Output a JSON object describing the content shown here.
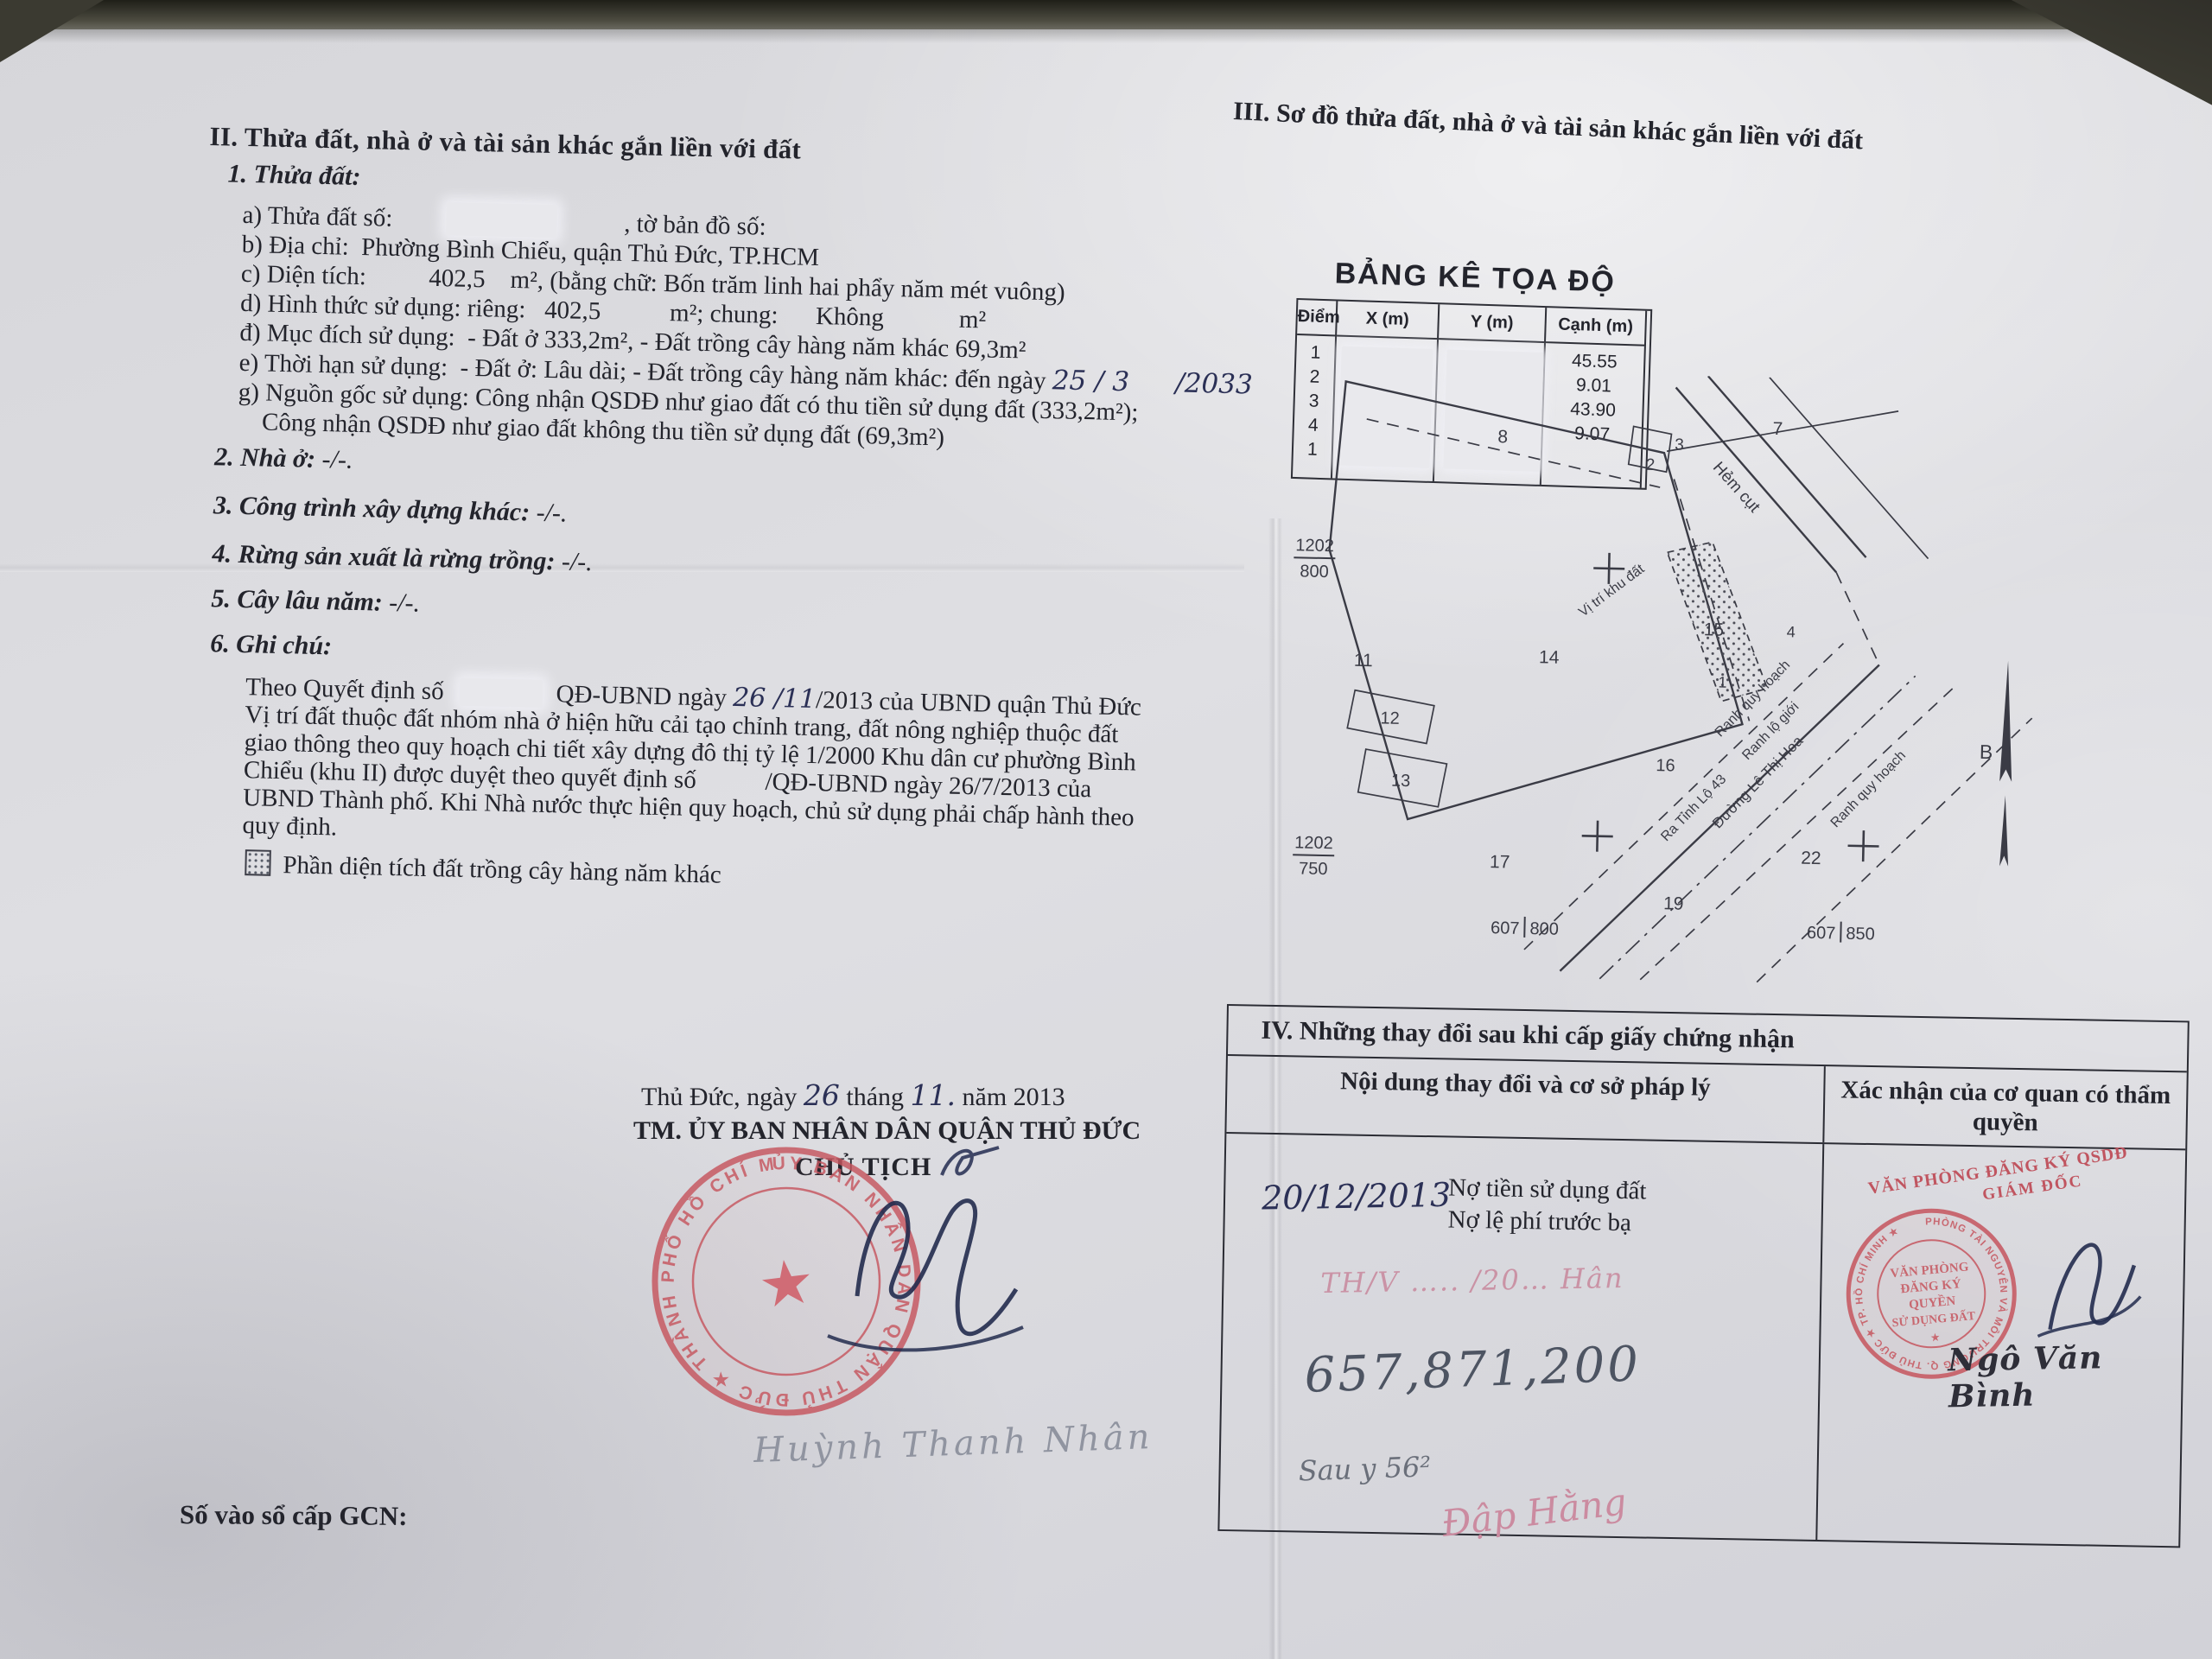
{
  "colors": {
    "paper": "#dcdce0",
    "ink": "#23242c",
    "stamp_red": "#c6555e",
    "handwriting_blue": "#2b3056",
    "handwriting_pink": "#c98ca0",
    "pencil_gray": "#4d5462"
  },
  "section2": {
    "title": "II. Thửa đất, nhà ở và tài sản khác gắn liền với đất",
    "sub_title": "1. Thửa đất:",
    "line_a_pre": "a) Thửa đất số:",
    "line_a_post": ", tờ bản đồ số:",
    "line_b": "b) Địa chỉ:  Phường Bình Chiểu, quận Thủ Đức, TP.HCM",
    "line_c": "c) Diện tích:          402,5    m², (bằng chữ: Bốn trăm linh hai phẩy năm mét vuông)",
    "line_d": "d) Hình thức sử dụng: riêng:   402,5           m²; chung:      Không            m²",
    "line_dd": "đ) Mục đích sử dụng:  - Đất ở 333,2m², - Đất trồng cây hàng năm khác 69,3m²",
    "line_e_pre": "e) Thời hạn sử dụng:  - Đất ở: Lâu dài; - Đất trồng cây hàng năm khác: đến ngày",
    "line_e_hw1": "25 / 3",
    "line_e_hw2": "/2033",
    "line_g1": "g) Nguồn gốc sử dụng: Công nhận QSDĐ như giao đất có thu tiền sử dụng đất (333,2m²);",
    "line_g2": "Công nhận QSDĐ như giao đất không thu tiền sử dụng đất (69,3m²)",
    "item2_label": "2. Nhà ở:",
    "item2_value": " -/-.",
    "item3_label": "3. Công trình xây dựng khác:",
    "item3_value": " -/-.",
    "item4_label": "4. Rừng sản xuất là rừng trồng:",
    "item4_value": " -/-.",
    "item5_label": "5. Cây lâu năm:",
    "item5_value": " -/-.",
    "item6_label": "6. Ghi chú:",
    "note1_pre": "Theo Quyết định số",
    "note1_mid": "QĐ-UBND ngày",
    "note1_hw": "26 /11",
    "note1_post": "/2013 của UBND quận Thủ Đức",
    "note2": "Vị trí đất thuộc đất nhóm nhà ở hiện hữu cải tạo chỉnh trang, đất nông nghiệp thuộc đất",
    "note3": "giao thông theo quy hoạch chi tiết xây dựng đô thị tỷ lệ 1/2000 Khu dân cư phường Bình",
    "note4": "Chiểu (khu II) được duyệt theo quyết định số           /QĐ-UBND ngày 26/7/2013 của",
    "note5": "UBND Thành phố. Khi Nhà nước thực hiện quy hoạch, chủ sử dụng phải chấp hành theo",
    "note6": "quy định.",
    "legend": "Phần diện tích đất trồng cây hàng năm khác"
  },
  "section3": {
    "title": "III. Sơ đồ thửa đất, nhà ở và tài sản khác gắn liền với đất",
    "table": {
      "title": "BẢNG KÊ TỌA ĐỘ",
      "headers": [
        "Điểm",
        "X (m)",
        "Y (m)",
        "Cạnh (m)"
      ],
      "points": [
        "1",
        "2",
        "3",
        "4",
        "1"
      ],
      "edges": [
        "",
        "45.55",
        "9.01",
        "43.90",
        "9.07"
      ]
    },
    "diagram": {
      "plots": {
        "p1": "1",
        "p2": "2",
        "p3": "3",
        "p4": "4",
        "p7": "7",
        "p8": "8",
        "p11": "11",
        "p12": "12",
        "p13": "13",
        "p14": "14",
        "p15": "15",
        "p16": "16",
        "p17": "17",
        "p19": "19",
        "p22": "22"
      },
      "labels": {
        "hem_cut": "Hẻm cụt",
        "vi_tri": "Vị trí khu đất",
        "ranh_qh1": "Ranh quy hoạch",
        "ranh_lg": "Ranh lộ giới",
        "ra_tl43": "Ra Tỉnh Lộ 43",
        "duong": "Đường Lê Thị Hoa",
        "ranh_qh2": "Ranh quy hoạch",
        "north": "B"
      },
      "coords": {
        "f1n": "1202",
        "f1d": "800",
        "f2n": "1202",
        "f2d": "750",
        "f3n": "607",
        "f3d": "800",
        "f4n": "607",
        "f4d": "850"
      }
    }
  },
  "section4": {
    "title": "IV. Những thay đổi sau khi cấp giấy chứng nhận",
    "col_content": "Nội dung thay đổi và cơ sở pháp lý",
    "col_confirm": "Xác nhận của cơ quan có thẩm quyền",
    "entry_date": "20/12/2013",
    "debt_line1": "Nợ tiền sử dụng đất",
    "debt_line2": "Nợ lệ phí trước bạ",
    "hw_ref": "TH/V ….. /20…   Hân",
    "hw_amount": "657,871,200",
    "hw_note": "Sau y 56²",
    "hw_sign": "Đập Hằng",
    "stamp_caption1": "VĂN PHÒNG ĐĂNG KÝ QSDĐ",
    "stamp_caption2": "GIÁM ĐỐC",
    "stamp_ring": "PHÒNG TÀI NGUYÊN VÀ MÔI TRƯỜNG Q. THỦ ĐỨC ★ TP. HỒ CHÍ MINH ★",
    "stamp_line1": "VĂN PHÒNG",
    "stamp_line2": "ĐĂNG KÝ",
    "stamp_line3": "QUYỀN",
    "stamp_line4": "SỬ DỤNG ĐẤT",
    "signer": "Ngô Văn Bình"
  },
  "signing": {
    "place_pre": "Thủ Đức, ngày",
    "hw_day": "26",
    "mid": "tháng",
    "hw_month": "11.",
    "tail": "năm 2013",
    "org": "TM. ỦY BAN NHÂN DÂN QUẬN THỦ ĐỨC",
    "role": "CHỦ TỊCH",
    "stamp_ring": "ỦY BAN NHÂN DÂN QUẬN THỦ ĐỨC ★ THÀNH PHỐ HỒ CHÍ MINH",
    "signer": "Huỳnh Thanh Nhân"
  },
  "footer": {
    "label": "Số vào sổ cấp GCN:"
  }
}
